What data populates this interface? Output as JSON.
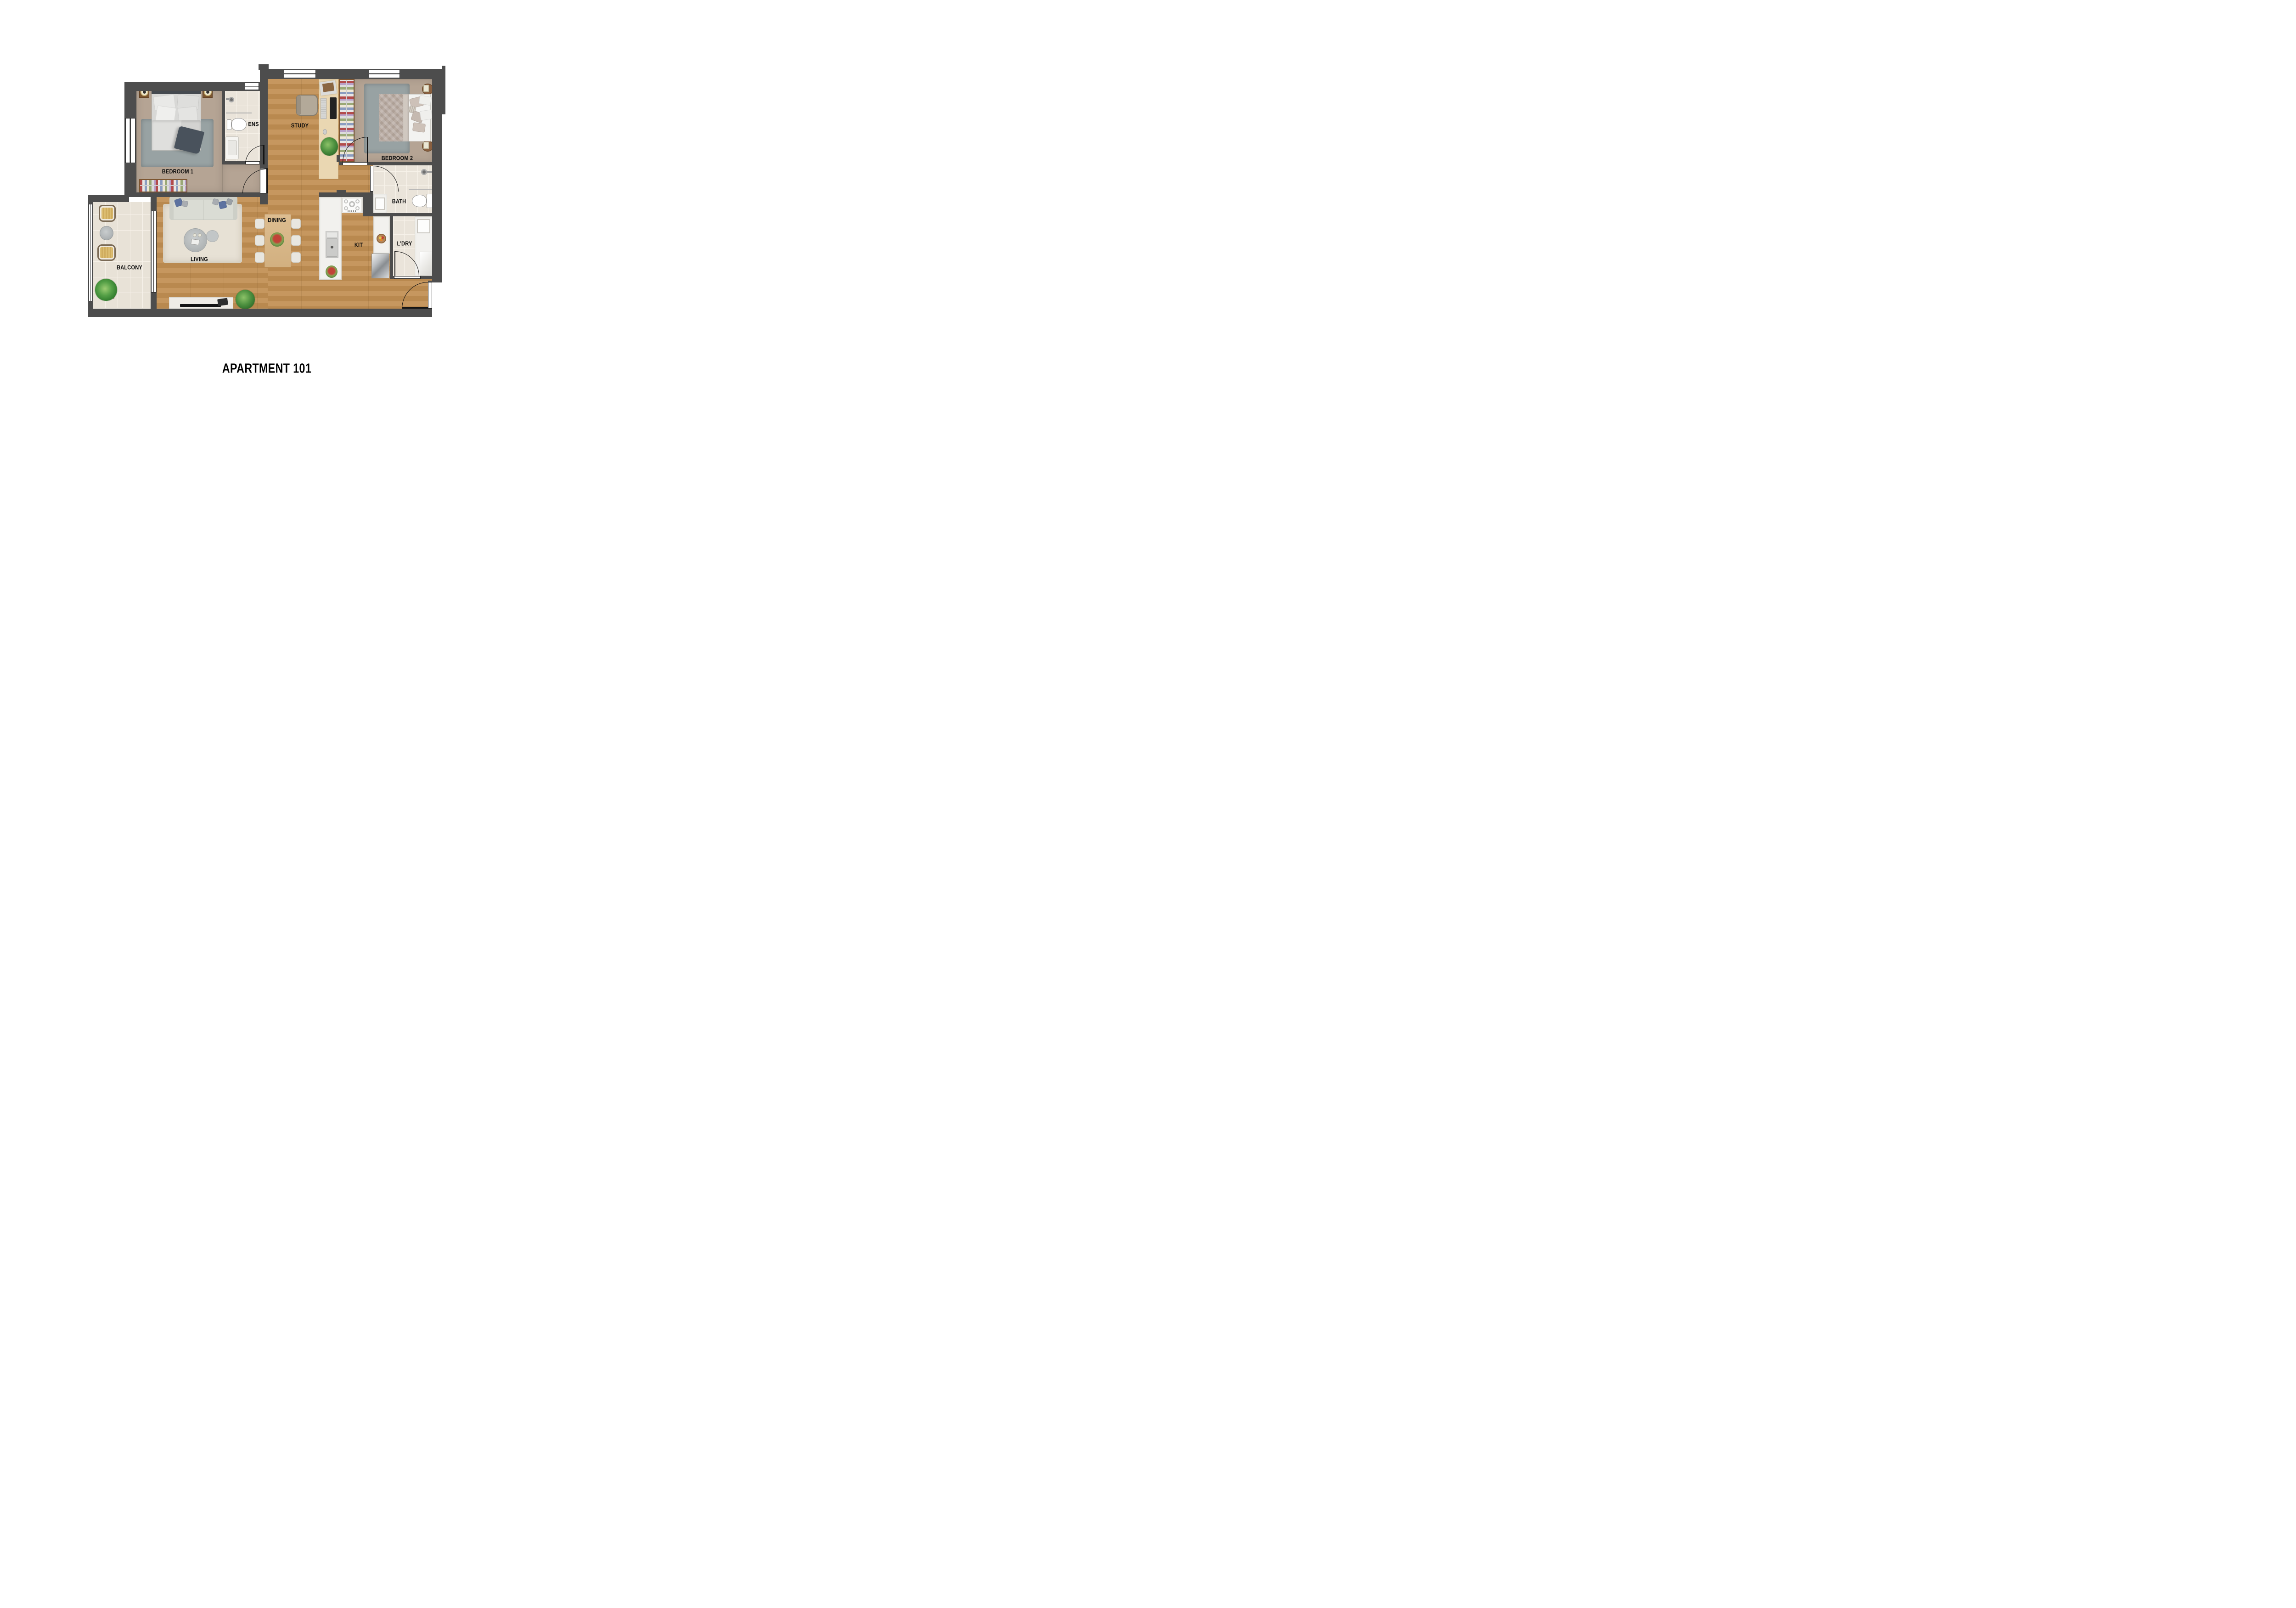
{
  "title": "APARTMENT 101",
  "rooms": [
    {
      "id": "bedroom1",
      "label": "BEDROOM 1"
    },
    {
      "id": "ens",
      "label": "ENS"
    },
    {
      "id": "study",
      "label": "STUDY"
    },
    {
      "id": "bedroom2",
      "label": "BEDROOM 2"
    },
    {
      "id": "bath",
      "label": "BATH"
    },
    {
      "id": "ldry",
      "label": "L’DRY"
    },
    {
      "id": "kit",
      "label": "KIT"
    },
    {
      "id": "dining",
      "label": "DINING"
    },
    {
      "id": "living",
      "label": "LIVING"
    },
    {
      "id": "balcony",
      "label": "BALCONY"
    }
  ],
  "colors": {
    "wall": "#4d4d4d",
    "wood1": "#c6975f",
    "wood2": "#b9894f",
    "carpet": "#b5a494",
    "tile": "#eae4da",
    "tileLine": "#f7f2ea",
    "balconyTile": "#e8e2d7",
    "counter": "#f2f1ee",
    "rugGray": "#98a2a3",
    "rugCream": "#e7e1d5",
    "sofa": "#dadcd4",
    "pillowBlue": "#5d72a0",
    "tableWood": "#d9b88a",
    "deskWood": "#ead7b2",
    "wardrobeWood": "#7c5530"
  }
}
